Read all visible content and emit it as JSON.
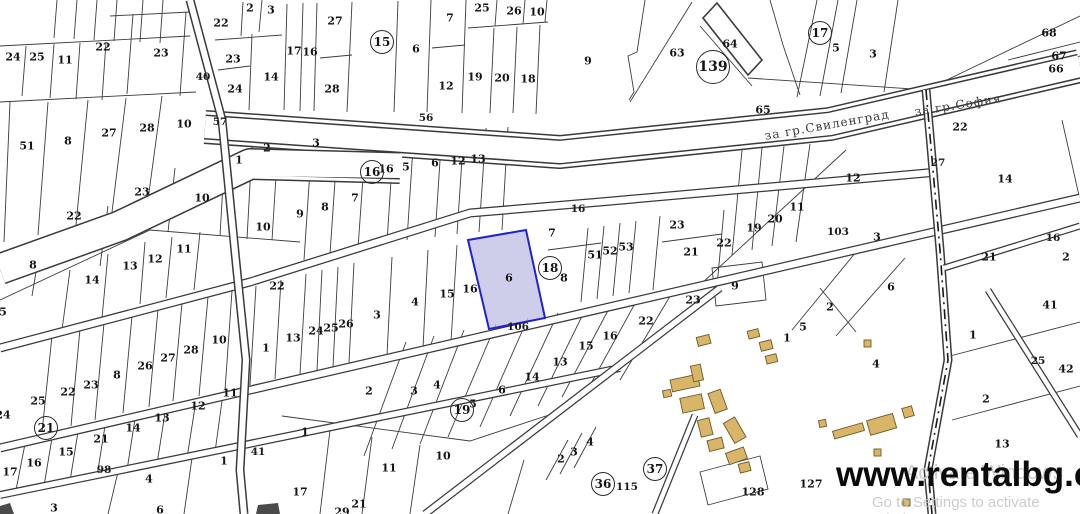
{
  "site": {
    "watermark": "www.rentalbg.com",
    "activate_hint_1": "Activate Windows",
    "activate_hint_2": "Go to Settings to activate Windows."
  },
  "map": {
    "highlighted_parcel": {
      "label": "6",
      "fill": "#c2c2e6",
      "fill_opacity": "0.8",
      "stroke": "#2121cf"
    },
    "colors": {
      "parcel_line": "#3c3c3c",
      "building_fill": "#d9b567",
      "building_stroke": "#6b5a2b",
      "background": "#ffffff"
    },
    "road_names": [
      {
        "t": "за гр.Свиленград",
        "x": 827,
        "y": 125,
        "rot": -10
      },
      {
        "t": "за гр.София",
        "x": 958,
        "y": 105,
        "rot": -9
      }
    ],
    "road_numbers": [
      {
        "t": "40",
        "x": 203,
        "y": 77
      },
      {
        "t": "57",
        "x": 220,
        "y": 122
      },
      {
        "t": "56",
        "x": 426,
        "y": 118
      },
      {
        "t": "16",
        "x": 578,
        "y": 209
      },
      {
        "t": "106",
        "x": 518,
        "y": 327
      },
      {
        "t": "103",
        "x": 838,
        "y": 232
      },
      {
        "t": "98",
        "x": 104,
        "y": 470
      },
      {
        "t": "27",
        "x": 938,
        "y": 163
      },
      {
        "t": "115",
        "x": 627,
        "y": 487
      },
      {
        "t": "16",
        "x": 1053,
        "y": 238
      },
      {
        "t": "41",
        "x": 258,
        "y": 452
      },
      {
        "t": "25",
        "x": 1038,
        "y": 361
      }
    ],
    "zone_markers": [
      {
        "t": "15",
        "x": 382,
        "y": 42
      },
      {
        "t": "16",
        "x": 372,
        "y": 172
      },
      {
        "t": "17",
        "x": 820,
        "y": 33
      },
      {
        "t": "18",
        "x": 550,
        "y": 268
      },
      {
        "t": "19",
        "x": 462,
        "y": 410
      },
      {
        "t": "21",
        "x": 46,
        "y": 428
      },
      {
        "t": "36",
        "x": 603,
        "y": 484
      },
      {
        "t": "37",
        "x": 655,
        "y": 469
      },
      {
        "t": "139",
        "x": 713,
        "y": 67,
        "r": 16
      }
    ],
    "parcel_numbers": [
      {
        "t": "24",
        "x": 13,
        "y": 57
      },
      {
        "t": "25",
        "x": 37,
        "y": 57
      },
      {
        "t": "11",
        "x": 65,
        "y": 60
      },
      {
        "t": "22",
        "x": 103,
        "y": 47
      },
      {
        "t": "23",
        "x": 161,
        "y": 53
      },
      {
        "t": "51",
        "x": 27,
        "y": 146
      },
      {
        "t": "8",
        "x": 68,
        "y": 141
      },
      {
        "t": "27",
        "x": 109,
        "y": 133
      },
      {
        "t": "28",
        "x": 147,
        "y": 128
      },
      {
        "t": "10",
        "x": 184,
        "y": 124
      },
      {
        "t": "2",
        "x": 250,
        "y": 8
      },
      {
        "t": "3",
        "x": 271,
        "y": 10
      },
      {
        "t": "22",
        "x": 221,
        "y": 23
      },
      {
        "t": "23",
        "x": 233,
        "y": 59
      },
      {
        "t": "24",
        "x": 235,
        "y": 89
      },
      {
        "t": "14",
        "x": 271,
        "y": 77
      },
      {
        "t": "17",
        "x": 294,
        "y": 51
      },
      {
        "t": "16",
        "x": 310,
        "y": 52
      },
      {
        "t": "27",
        "x": 335,
        "y": 21
      },
      {
        "t": "28",
        "x": 332,
        "y": 89
      },
      {
        "t": "6",
        "x": 416,
        "y": 49
      },
      {
        "t": "7",
        "x": 450,
        "y": 18
      },
      {
        "t": "12",
        "x": 446,
        "y": 86
      },
      {
        "t": "19",
        "x": 475,
        "y": 77
      },
      {
        "t": "20",
        "x": 502,
        "y": 78
      },
      {
        "t": "18",
        "x": 528,
        "y": 79
      },
      {
        "t": "25",
        "x": 482,
        "y": 8
      },
      {
        "t": "26",
        "x": 514,
        "y": 11
      },
      {
        "t": "10",
        "x": 537,
        "y": 12
      },
      {
        "t": "9",
        "x": 588,
        "y": 61
      },
      {
        "t": "63",
        "x": 677,
        "y": 53
      },
      {
        "t": "64",
        "x": 730,
        "y": 44
      },
      {
        "t": "65",
        "x": 763,
        "y": 110
      },
      {
        "t": "5",
        "x": 836,
        "y": 48
      },
      {
        "t": "3",
        "x": 873,
        "y": 54
      },
      {
        "t": "68",
        "x": 1049,
        "y": 33
      },
      {
        "t": "67",
        "x": 1059,
        "y": 56
      },
      {
        "t": "66",
        "x": 1056,
        "y": 69
      },
      {
        "t": "22",
        "x": 960,
        "y": 127
      },
      {
        "t": "1",
        "x": 239,
        "y": 160
      },
      {
        "t": "23",
        "x": 142,
        "y": 192
      },
      {
        "t": "22",
        "x": 74,
        "y": 216
      },
      {
        "t": "10",
        "x": 202,
        "y": 198
      },
      {
        "t": "10",
        "x": 263,
        "y": 227
      },
      {
        "t": "8",
        "x": 33,
        "y": 265
      },
      {
        "t": "14",
        "x": 92,
        "y": 280
      },
      {
        "t": "13",
        "x": 130,
        "y": 266
      },
      {
        "t": "12",
        "x": 155,
        "y": 259
      },
      {
        "t": "11",
        "x": 184,
        "y": 249
      },
      {
        "t": "5",
        "x": 3,
        "y": 312
      },
      {
        "t": "2",
        "x": 267,
        "y": 148
      },
      {
        "t": "3",
        "x": 316,
        "y": 143
      },
      {
        "t": "16",
        "x": 386,
        "y": 169
      },
      {
        "t": "5",
        "x": 406,
        "y": 167
      },
      {
        "t": "6",
        "x": 435,
        "y": 163
      },
      {
        "t": "12",
        "x": 458,
        "y": 161
      },
      {
        "t": "13",
        "x": 478,
        "y": 159
      },
      {
        "t": "9",
        "x": 300,
        "y": 214
      },
      {
        "t": "8",
        "x": 325,
        "y": 207
      },
      {
        "t": "7",
        "x": 355,
        "y": 198
      },
      {
        "t": "22",
        "x": 277,
        "y": 286
      },
      {
        "t": "12",
        "x": 853,
        "y": 178
      },
      {
        "t": "14",
        "x": 1005,
        "y": 179
      },
      {
        "t": "11",
        "x": 797,
        "y": 207
      },
      {
        "t": "20",
        "x": 775,
        "y": 219
      },
      {
        "t": "19",
        "x": 754,
        "y": 228
      },
      {
        "t": "22",
        "x": 724,
        "y": 243
      },
      {
        "t": "9",
        "x": 735,
        "y": 286
      },
      {
        "t": "3",
        "x": 877,
        "y": 237
      },
      {
        "t": "6",
        "x": 891,
        "y": 287
      },
      {
        "t": "2",
        "x": 830,
        "y": 307
      },
      {
        "t": "5",
        "x": 803,
        "y": 327
      },
      {
        "t": "21",
        "x": 989,
        "y": 257
      },
      {
        "t": "2",
        "x": 1066,
        "y": 257
      },
      {
        "t": "41",
        "x": 1050,
        "y": 305
      },
      {
        "t": "25",
        "x": 38,
        "y": 401
      },
      {
        "t": "22",
        "x": 68,
        "y": 392
      },
      {
        "t": "23",
        "x": 91,
        "y": 385
      },
      {
        "t": "8",
        "x": 117,
        "y": 375
      },
      {
        "t": "26",
        "x": 145,
        "y": 366
      },
      {
        "t": "27",
        "x": 168,
        "y": 358
      },
      {
        "t": "28",
        "x": 191,
        "y": 350
      },
      {
        "t": "10",
        "x": 219,
        "y": 340
      },
      {
        "t": "1",
        "x": 266,
        "y": 348
      },
      {
        "t": "13",
        "x": 293,
        "y": 338
      },
      {
        "t": "24",
        "x": 316,
        "y": 331
      },
      {
        "t": "25",
        "x": 331,
        "y": 328
      },
      {
        "t": "26",
        "x": 346,
        "y": 324
      },
      {
        "t": "3",
        "x": 377,
        "y": 315
      },
      {
        "t": "4",
        "x": 415,
        "y": 302
      },
      {
        "t": "15",
        "x": 447,
        "y": 294
      },
      {
        "t": "16",
        "x": 470,
        "y": 289
      },
      {
        "t": "6",
        "x": 509,
        "y": 278
      },
      {
        "t": "7",
        "x": 552,
        "y": 233
      },
      {
        "t": "8",
        "x": 564,
        "y": 278
      },
      {
        "t": "51",
        "x": 595,
        "y": 255
      },
      {
        "t": "52",
        "x": 610,
        "y": 251
      },
      {
        "t": "53",
        "x": 626,
        "y": 247
      },
      {
        "t": "23",
        "x": 677,
        "y": 225
      },
      {
        "t": "21",
        "x": 691,
        "y": 252
      },
      {
        "t": "24",
        "x": 3,
        "y": 415
      },
      {
        "t": "21",
        "x": 101,
        "y": 439
      },
      {
        "t": "14",
        "x": 133,
        "y": 428
      },
      {
        "t": "13",
        "x": 162,
        "y": 418
      },
      {
        "t": "12",
        "x": 198,
        "y": 406
      },
      {
        "t": "11",
        "x": 230,
        "y": 393
      },
      {
        "t": "15",
        "x": 66,
        "y": 452
      },
      {
        "t": "16",
        "x": 34,
        "y": 463
      },
      {
        "t": "17",
        "x": 10,
        "y": 472
      },
      {
        "t": "23",
        "x": 693,
        "y": 300
      },
      {
        "t": "22",
        "x": 646,
        "y": 321
      },
      {
        "t": "16",
        "x": 610,
        "y": 336
      },
      {
        "t": "15",
        "x": 586,
        "y": 346
      },
      {
        "t": "13",
        "x": 560,
        "y": 362
      },
      {
        "t": "14",
        "x": 532,
        "y": 377
      },
      {
        "t": "6",
        "x": 502,
        "y": 390
      },
      {
        "t": "4",
        "x": 437,
        "y": 385
      },
      {
        "t": "3",
        "x": 414,
        "y": 391
      },
      {
        "t": "2",
        "x": 369,
        "y": 391
      },
      {
        "t": "5",
        "x": 473,
        "y": 404
      },
      {
        "t": "1",
        "x": 305,
        "y": 432
      },
      {
        "t": "10",
        "x": 443,
        "y": 456
      },
      {
        "t": "11",
        "x": 389,
        "y": 468
      },
      {
        "t": "17",
        "x": 300,
        "y": 492
      },
      {
        "t": "21",
        "x": 359,
        "y": 504
      },
      {
        "t": "29",
        "x": 342,
        "y": 512
      },
      {
        "t": "1",
        "x": 224,
        "y": 461
      },
      {
        "t": "4",
        "x": 149,
        "y": 479
      },
      {
        "t": "3",
        "x": 54,
        "y": 508
      },
      {
        "t": "6",
        "x": 160,
        "y": 510
      },
      {
        "t": "1",
        "x": 787,
        "y": 338
      },
      {
        "t": "2",
        "x": 561,
        "y": 459
      },
      {
        "t": "3",
        "x": 574,
        "y": 452
      },
      {
        "t": "4",
        "x": 590,
        "y": 442
      },
      {
        "t": "128",
        "x": 753,
        "y": 492
      },
      {
        "t": "127",
        "x": 811,
        "y": 484
      },
      {
        "t": "4",
        "x": 876,
        "y": 364
      },
      {
        "t": "1",
        "x": 973,
        "y": 335
      },
      {
        "t": "2",
        "x": 986,
        "y": 399
      },
      {
        "t": "13",
        "x": 1002,
        "y": 444
      },
      {
        "t": "42",
        "x": 1066,
        "y": 369
      }
    ]
  }
}
